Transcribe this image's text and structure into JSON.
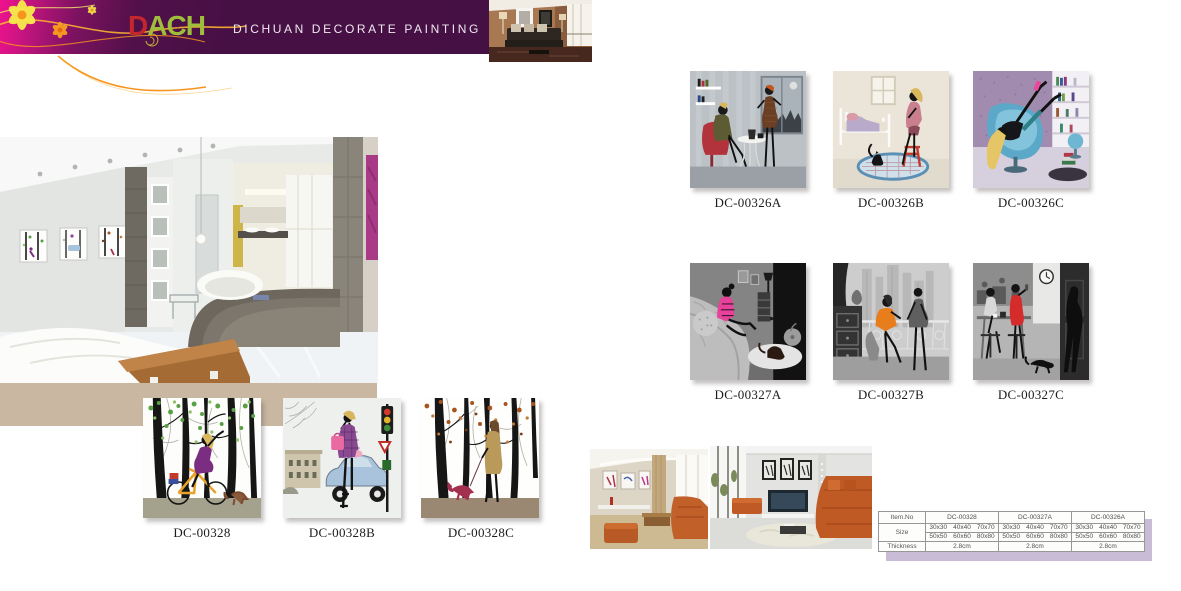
{
  "header": {
    "logo": {
      "d": "D",
      "a": "A",
      "c": "C",
      "h": "H",
      "flower_glyph": "✿"
    },
    "tagline": "DICHUAN DECORATE PAINTING"
  },
  "products": {
    "row1": [
      {
        "code": "DC-00326A"
      },
      {
        "code": "DC-00326B"
      },
      {
        "code": "DC-00326C"
      }
    ],
    "row2": [
      {
        "code": "DC-00327A"
      },
      {
        "code": "DC-00327B"
      },
      {
        "code": "DC-00327C"
      }
    ],
    "row3": [
      {
        "code": "DC-00328"
      },
      {
        "code": "DC-00328B"
      },
      {
        "code": "DC-00328C"
      }
    ]
  },
  "spec_table": {
    "item_no_label": "Item.No",
    "size_label": "Size",
    "thickness_label": "Thickness",
    "columns": [
      {
        "item_no": "DC-00328",
        "sizes_row1": [
          "30x30",
          "40x40",
          "70x70"
        ],
        "sizes_row2": [
          "50x50",
          "60x60",
          "80x80"
        ],
        "thickness": "2.8cm"
      },
      {
        "item_no": "DC-00327A",
        "sizes_row1": [
          "30x30",
          "40x40",
          "70x70"
        ],
        "sizes_row2": [
          "50x50",
          "60x60",
          "80x80"
        ],
        "thickness": "2.8cm"
      },
      {
        "item_no": "DC-00326A",
        "sizes_row1": [
          "30x30",
          "40x40",
          "70x70"
        ],
        "sizes_row2": [
          "50x50",
          "60x60",
          "80x80"
        ],
        "thickness": "2.8cm"
      }
    ]
  },
  "colors": {
    "header_purple": "#461043",
    "header_magenta": "#f0128d",
    "logo_red": "#c1272d",
    "logo_green": "#9fbe3b",
    "tan_band": "#c9b7a1",
    "table_shadow": "#c9bcd6"
  }
}
